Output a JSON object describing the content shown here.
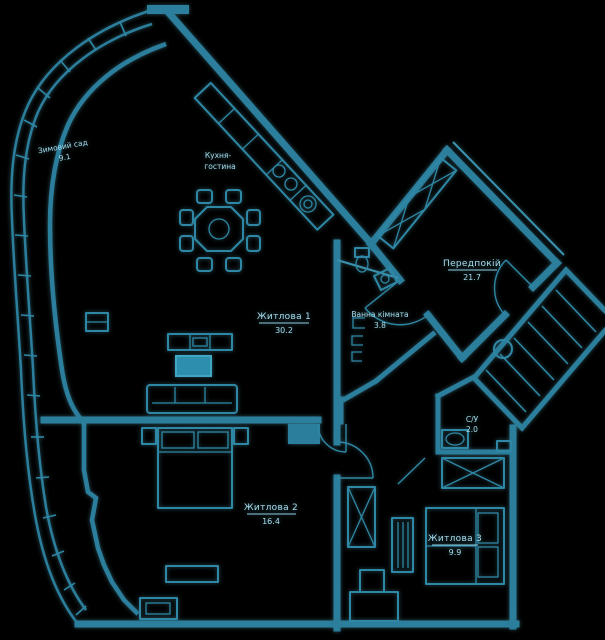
{
  "plan": {
    "colors": {
      "background": "#000000",
      "wall": "#2b7f9d",
      "accent": "#5fc0d8",
      "text": "#a7dcea"
    },
    "rooms": {
      "winter_garden": {
        "name": "Зимовий сад",
        "area": "9.1"
      },
      "kitchen": {
        "line1": "Кухня-",
        "line2": "гостина"
      },
      "living": {
        "name": "Житлова 1",
        "area": "30.2"
      },
      "hall": {
        "name": "Передпокій",
        "area": "21.7"
      },
      "bathroom": {
        "name": "Ванна кімната",
        "area": "3.8"
      },
      "wc": {
        "name": "С/У",
        "area": "2.0"
      },
      "bedroom": {
        "name": "Житлова 2",
        "area": "16.4"
      },
      "bedroom2": {
        "name": "Житлова 3",
        "area": "9.9"
      }
    }
  }
}
